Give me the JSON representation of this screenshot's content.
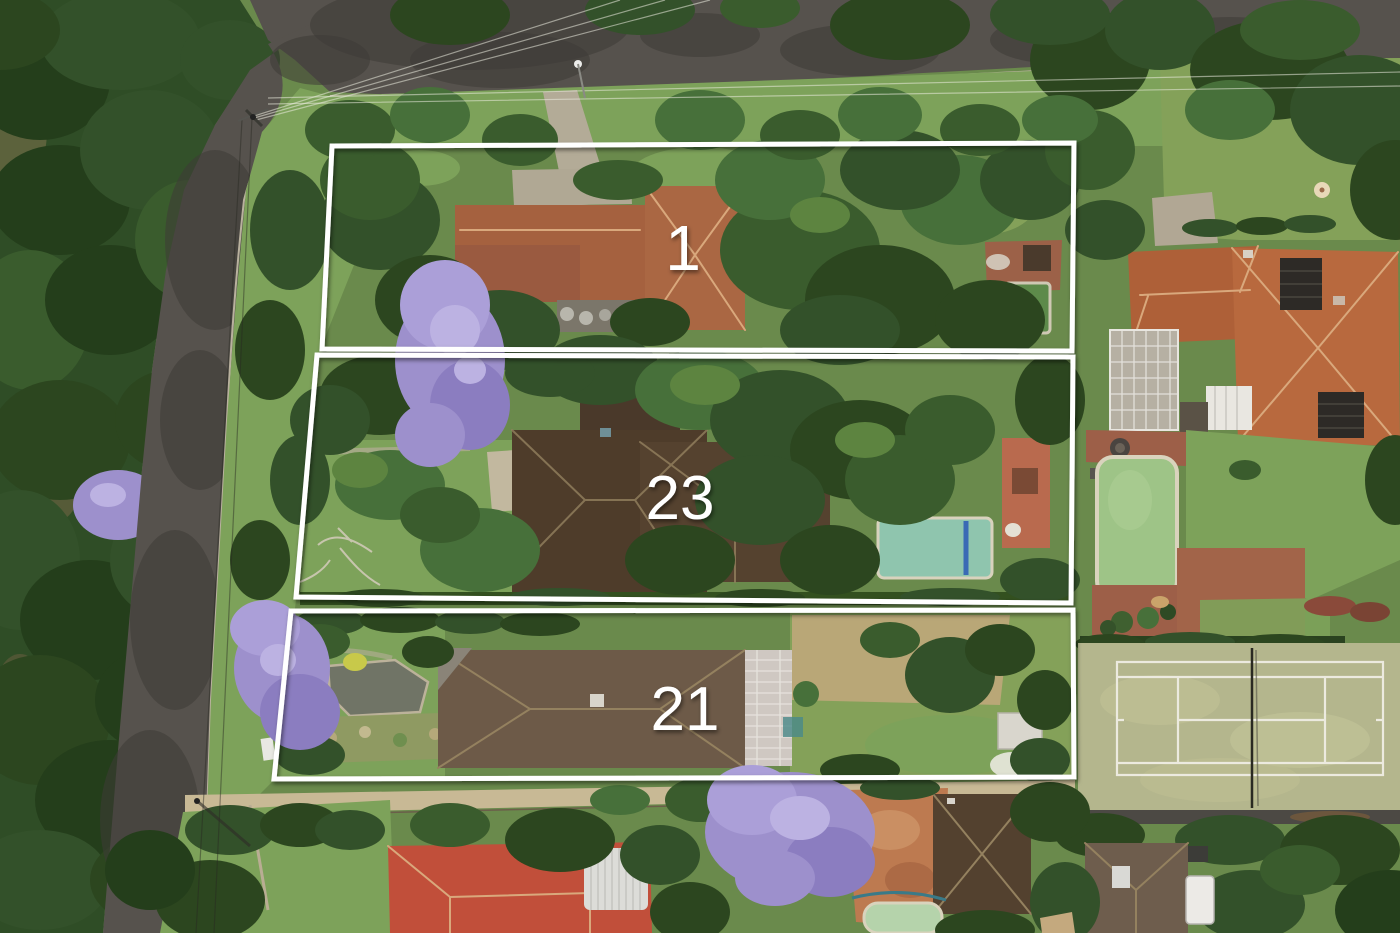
{
  "image": {
    "type": "aerial-photograph",
    "description": "Drone aerial view of three adjacent suburban residential lots outlined in white and numbered, bordered by tree-lined streets, with neighbouring houses, swimming pools, blooming jacaranda trees and a grass tennis court",
    "width_px": 1400,
    "height_px": 933
  },
  "overlay": {
    "boundary_color": "#ffffff",
    "lots": [
      {
        "id": "lot-1",
        "label": "1",
        "points": "332,146 1074,143 1072,351 322,349"
      },
      {
        "id": "lot-23",
        "label": "23",
        "points": "317,355 1073,357 1071,603 296,597"
      },
      {
        "id": "lot-21",
        "label": "21",
        "points": "291,611 1073,610 1074,777 274,779"
      }
    ]
  },
  "scene": {
    "colors": {
      "grass": "#6a8a4c",
      "bright_lawn": "#7da25a",
      "road": "#56524d",
      "footpath": "#c8b995",
      "tennis_court": "#b4b68d",
      "court_line": "#eceadf",
      "jacaranda": "#9d90cc",
      "lot1_roof": "#a5613f",
      "lot23_roof": "#4e3c2a",
      "lot21_roof": "#6d5a48",
      "neighbor_roof": "#b8693e",
      "red_roof": "#c14f3a",
      "pyramid_roof": "#53412f",
      "shingle_roof": "#6e5d4d",
      "pool_aqua": "#8fc5ae",
      "pool_green": "#9ec487",
      "pool_dark_green": "#5d8a4a",
      "pool_pale": "#b5d3ab",
      "dirt": "#bd7a50",
      "brick_paving": "#9d5f48",
      "pergola_white": "#cfc8c2"
    },
    "features": [
      "tree-lined street junction at top left with power lines and poles",
      "three white-outlined lots numbered 1, 23 and 21",
      "terracotta tile roof house with driveway and dark green pool on lot 1",
      "dark brown roof house, aqua pool and terracotta patio on lot 23",
      "brown roof house with white glass pergola, garden pond and shed on lot 21",
      "neighbouring estate at right with orange tile roof, conservatory, green pool and grass tennis court",
      "jacaranda trees in purple bloom",
      "rear street with red tile roof house, brown pyramid roof house and small pool at bottom"
    ]
  }
}
